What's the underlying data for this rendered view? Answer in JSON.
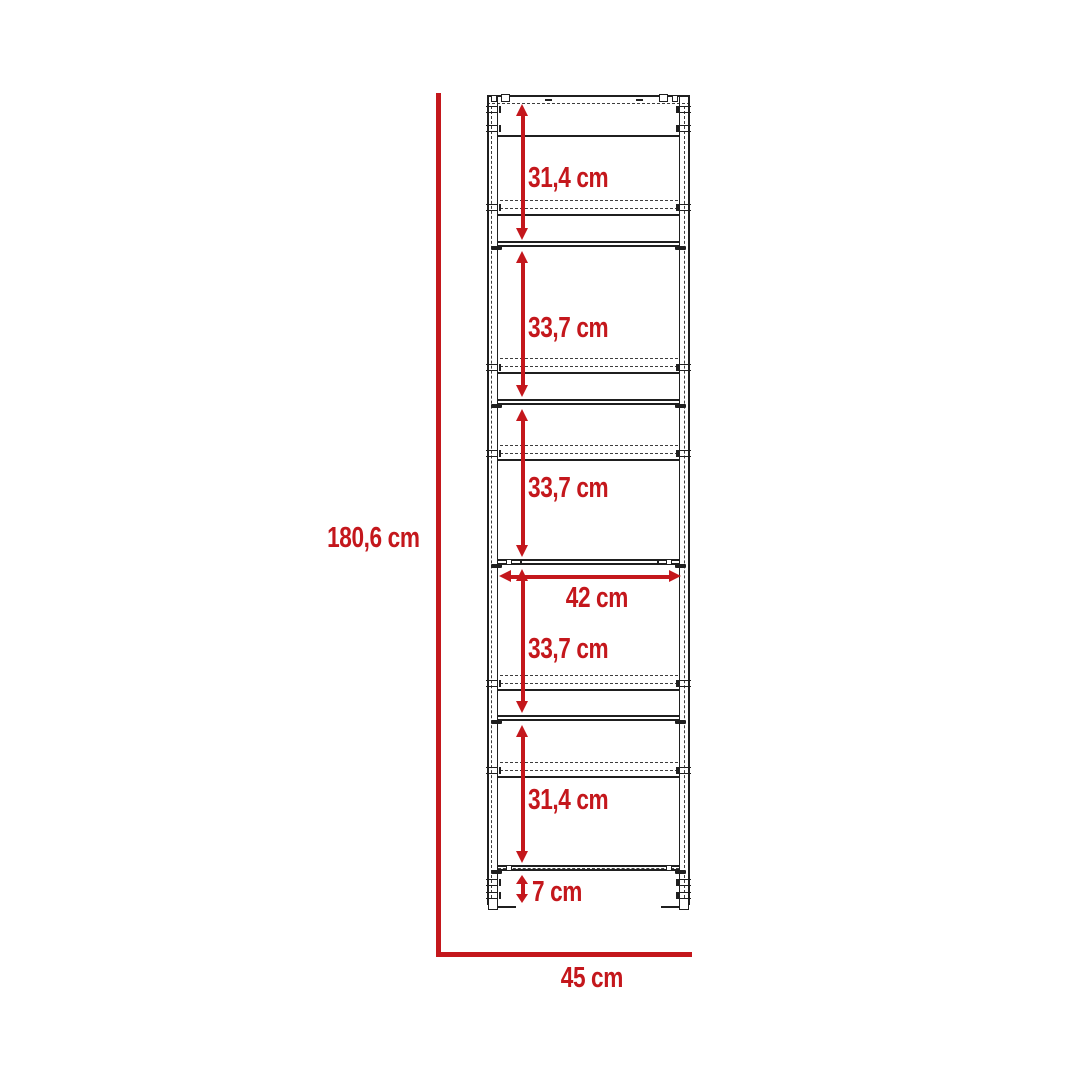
{
  "colors": {
    "dimension_red": "#c4171c",
    "line_color": "#1f1f1f"
  },
  "labels": {
    "overall_height": "180,6 cm",
    "overall_width": "45 cm",
    "interior_width": "42 cm",
    "base_height": "7 cm"
  },
  "sections": [
    {
      "label": "31,4 cm"
    },
    {
      "label": "33,7 cm"
    },
    {
      "label": "33,7 cm"
    },
    {
      "label": "33,7 cm"
    },
    {
      "label": "31,4 cm"
    }
  ]
}
